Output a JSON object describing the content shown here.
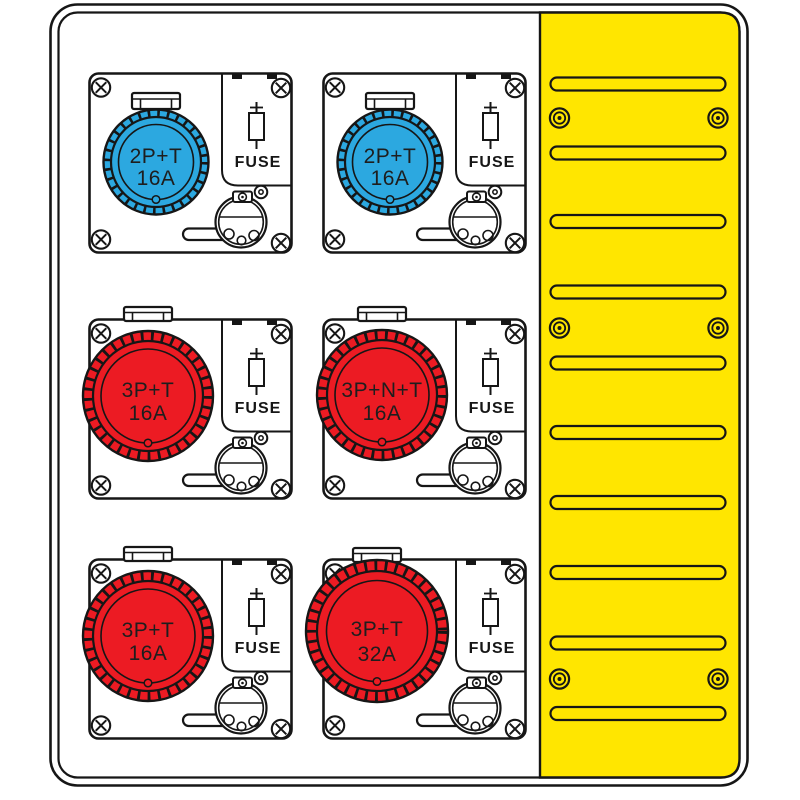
{
  "colors": {
    "vent_panel": "#FFE600",
    "socket_blue": "#2CA8E0",
    "socket_red": "#EC1B23",
    "outline": "#161616",
    "plate": "#FFFFFF"
  },
  "vent_panel": {
    "slot_count": 10,
    "screw_count": 6
  },
  "modules": [
    {
      "socket": "2P+T",
      "rating": "16A",
      "fuse_label": "FUSE",
      "color": "#2CA8E0"
    },
    {
      "socket": "2P+T",
      "rating": "16A",
      "fuse_label": "FUSE",
      "color": "#2CA8E0"
    },
    {
      "socket": "3P+T",
      "rating": "16A",
      "fuse_label": "FUSE",
      "color": "#EC1B23"
    },
    {
      "socket": "3P+N+T",
      "rating": "16A",
      "fuse_label": "FUSE",
      "color": "#EC1B23"
    },
    {
      "socket": "3P+T",
      "rating": "16A",
      "fuse_label": "FUSE",
      "color": "#EC1B23"
    },
    {
      "socket": "3P+T",
      "rating": "32A",
      "fuse_label": "FUSE",
      "color": "#EC1B23"
    }
  ]
}
